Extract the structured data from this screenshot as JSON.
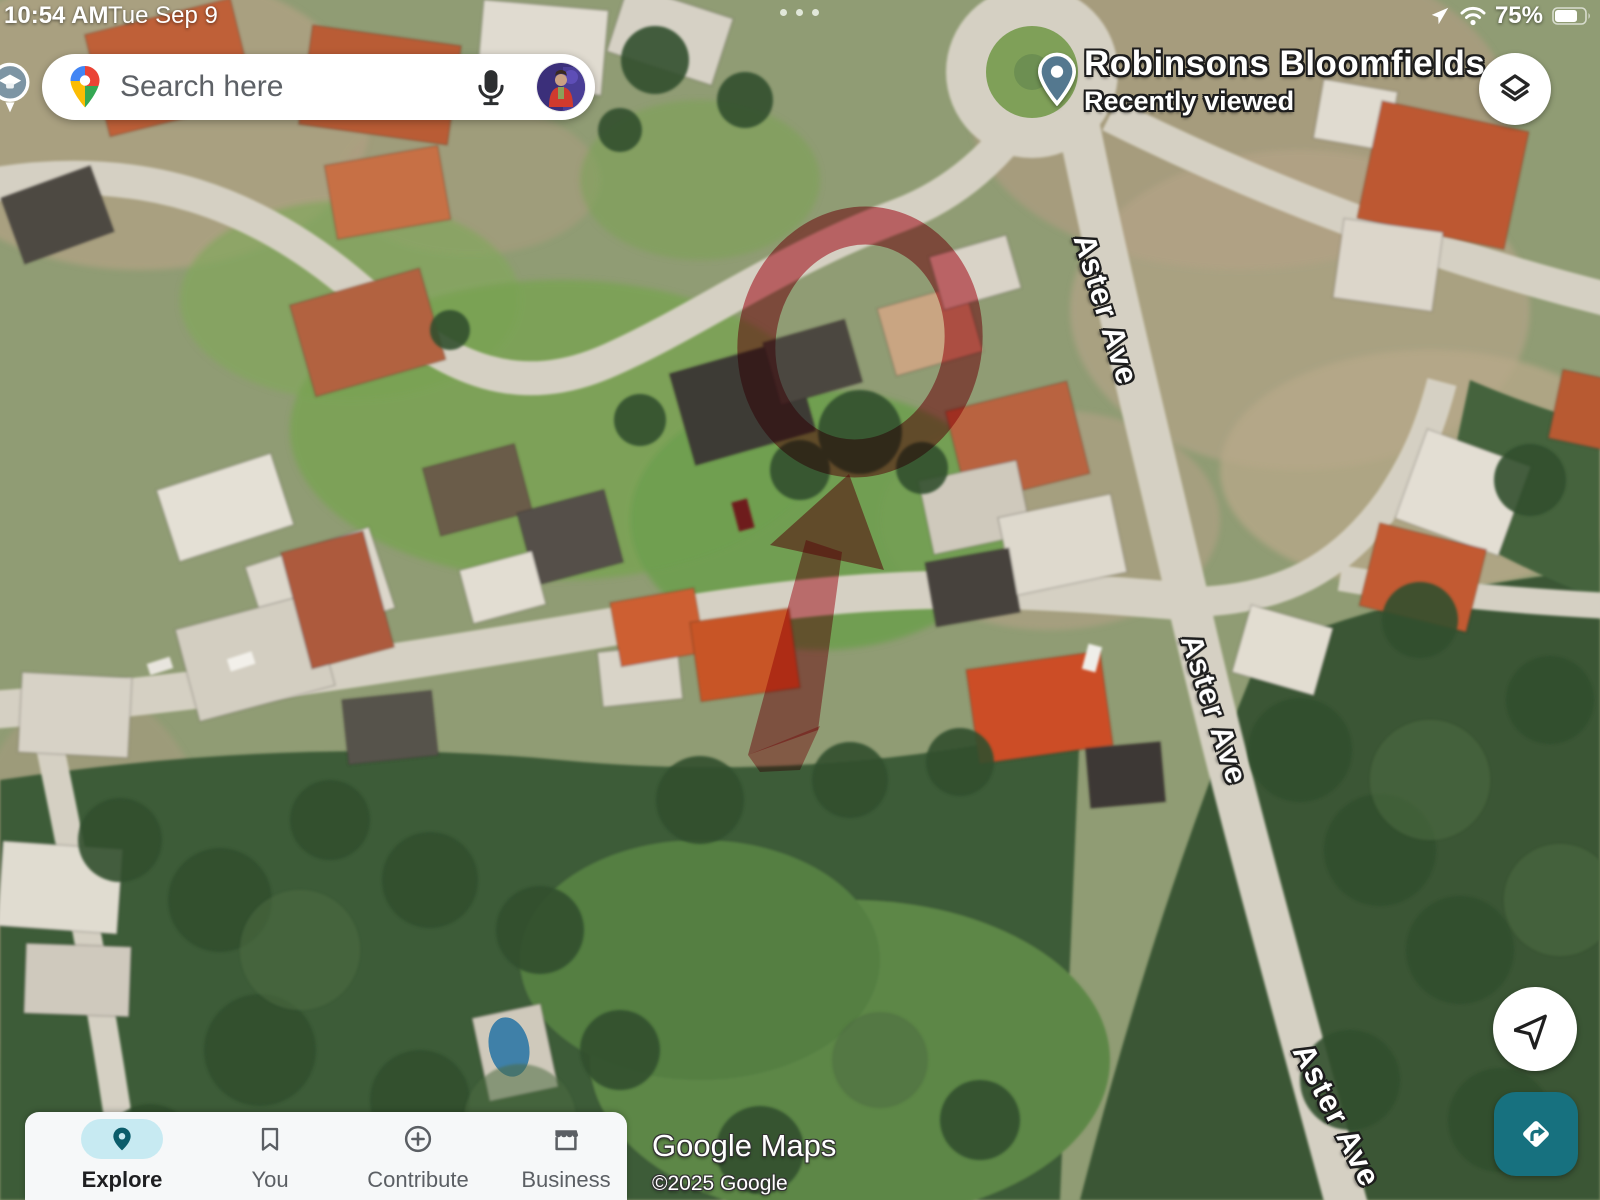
{
  "status_bar": {
    "time": "10:54 AM",
    "date": "Tue Sep 9",
    "battery_percent": "75%",
    "icons": [
      "location-arrow-icon",
      "wifi-icon",
      "battery-icon"
    ]
  },
  "search_bar": {
    "placeholder": "Search here",
    "logo_icon": "google-maps-pin-logo",
    "mic_icon": "microphone-icon",
    "avatar": "user-avatar-photo"
  },
  "map": {
    "view": "satellite",
    "poi_label": {
      "title": "Robinsons Bloomfields",
      "subtitle": "Recently viewed"
    },
    "road_labels": [
      {
        "text": "Aster Ave"
      },
      {
        "text": "Aster Ave"
      },
      {
        "text": "Aster Ave"
      }
    ],
    "markers": [
      "school-poi-marker",
      "recently-viewed-pin"
    ],
    "annotation": {
      "description": "hand-drawn red circle with upward arrow over property",
      "color": "#b51322"
    },
    "watermark": {
      "brand": "Google Maps",
      "copyright": "©2025 Google"
    }
  },
  "controls": {
    "layers_button": "map-type-layers",
    "my_location_button": "my-location",
    "directions_button": "directions"
  },
  "bottom_nav": {
    "items": [
      {
        "label": "Explore",
        "active": true
      },
      {
        "label": "You",
        "active": false
      },
      {
        "label": "Contribute",
        "active": false
      },
      {
        "label": "Business",
        "active": false
      }
    ]
  },
  "colors": {
    "explore_pill": "#c7eaf2",
    "explore_pin": "#0b5d6b",
    "directions_teal": "#17717f",
    "annotation_red": "#b51322",
    "nav_inactive": "#5b5f64"
  }
}
